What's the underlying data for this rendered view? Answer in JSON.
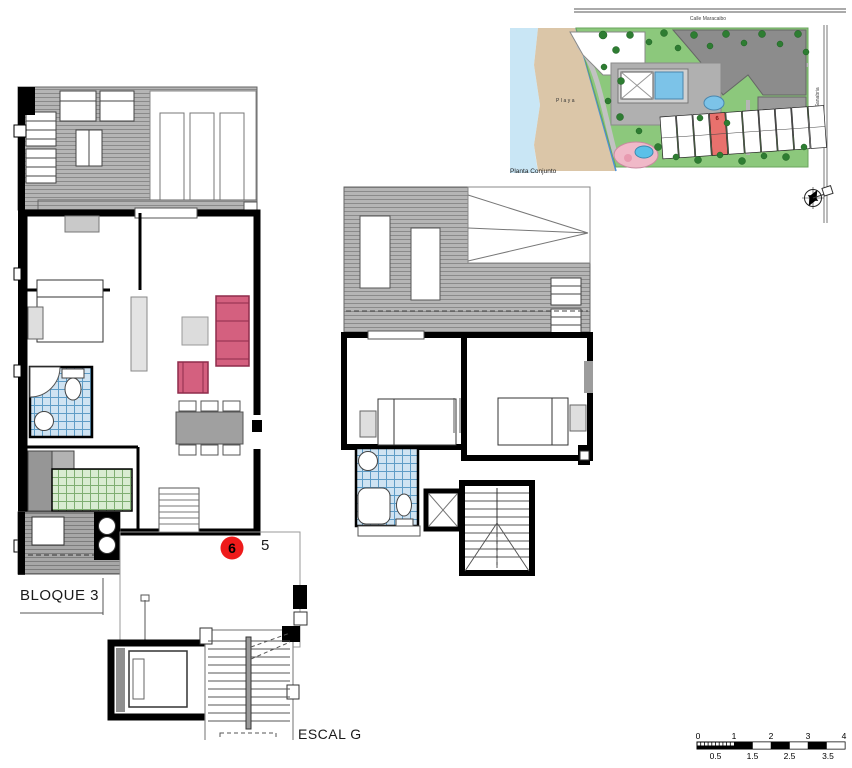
{
  "labels": {
    "block": "BLOQUE 3",
    "stair": "ESCAL G",
    "site_title": "Planta Conjunto",
    "beach": "Playa",
    "street_top": "Calle Maracaibo",
    "street_right": "Calle Lago Sanabria",
    "adjacent_unit": "5"
  },
  "unit_marker": {
    "number": "6",
    "color": "#ee1b1b"
  },
  "site_plan": {
    "highlighted_unit": "6",
    "highlight_color": "#e8716d"
  },
  "scale_bar": {
    "top": [
      "0",
      "1",
      "2",
      "3",
      "4"
    ],
    "bottom": [
      "0.5",
      "1.5",
      "2.5",
      "3.5"
    ]
  },
  "colors": {
    "wall": "#000000",
    "deck": "#b5b5b5",
    "bath_tile": "#cfe3f2",
    "kitchen_tile": "#d9ecd2",
    "sofa": "#d4607f",
    "water": "#c9e6f5",
    "sand": "#dbc6a8",
    "lawn": "#8cc87c",
    "pool": "#7cc3e8",
    "roof": "#8c8c8c"
  }
}
